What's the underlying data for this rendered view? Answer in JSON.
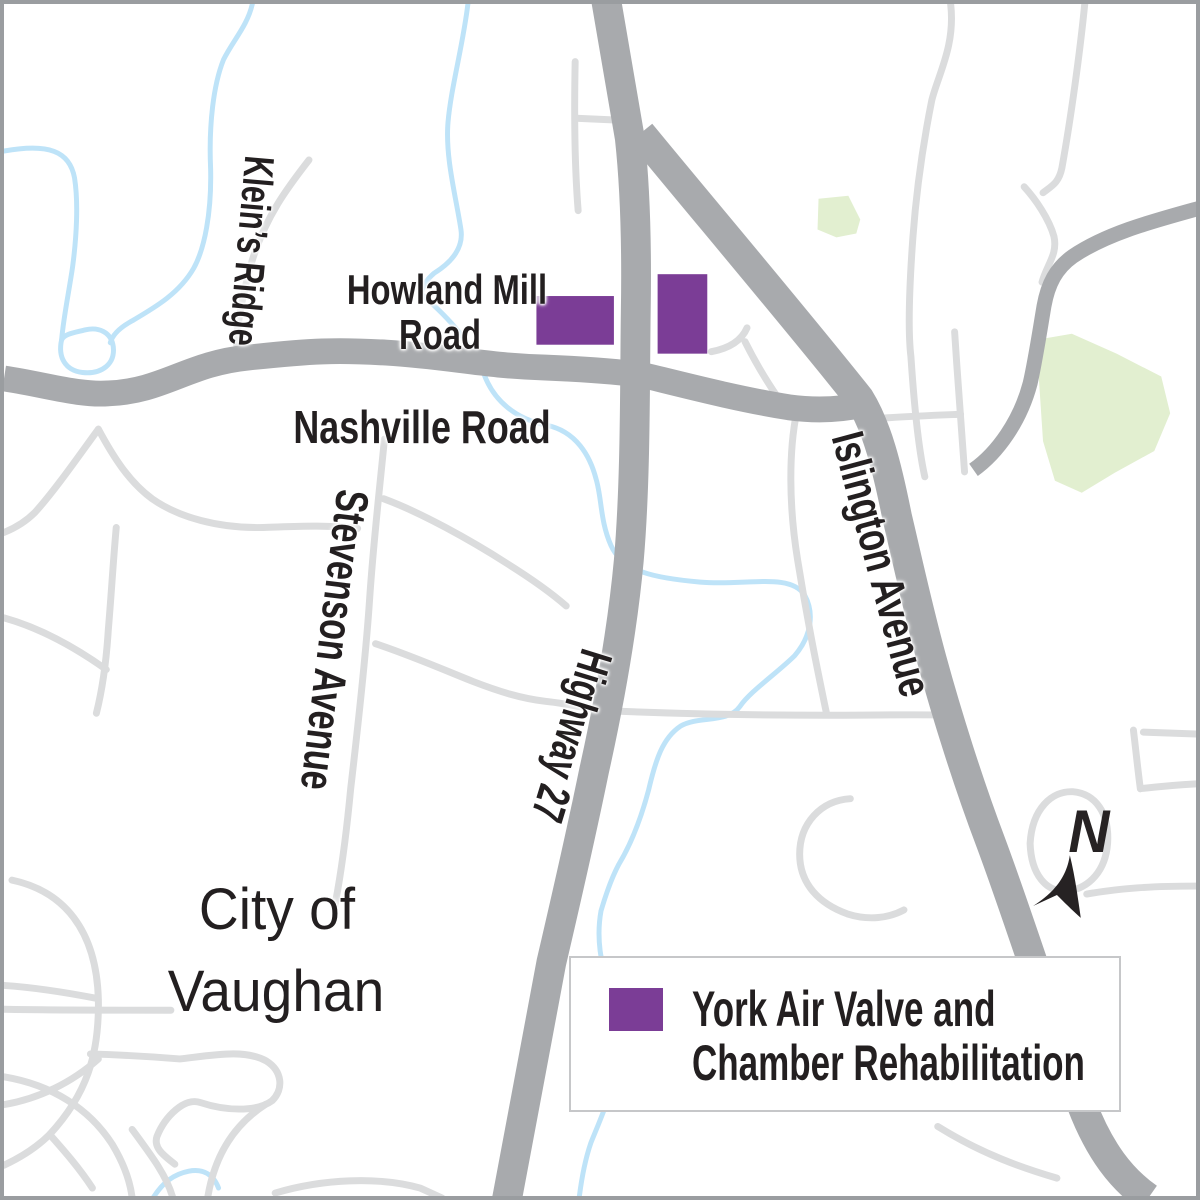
{
  "map": {
    "region_label": {
      "line1": "City of",
      "line2": "Vaughan"
    },
    "road_labels": {
      "kleins_ridge": "Klein’s Ridge",
      "howland_line1": "Howland Mill",
      "howland_line2": "Road",
      "nashville": "Nashville Road",
      "stevenson": "Stevenson Avenue",
      "highway_27": "Highway 27",
      "islington": "Islington Avenue"
    },
    "north_arrow": {
      "letter": "N"
    }
  },
  "legend": {
    "items": [
      {
        "swatch_color": "#7B3D96",
        "label_line1": "York Air Valve and",
        "label_line2": "Chamber Rehabilitation"
      }
    ]
  },
  "colors": {
    "project_purple": "#7B3D96",
    "road_major": "#A8AAAD",
    "road_minor": "#DBDCDD",
    "water_blue": "#BEE3F8",
    "park_green": "#E2EFD0",
    "map_border": "#9A9DA0",
    "label_text": "#231F20",
    "north_arrow_black": "#262223"
  }
}
